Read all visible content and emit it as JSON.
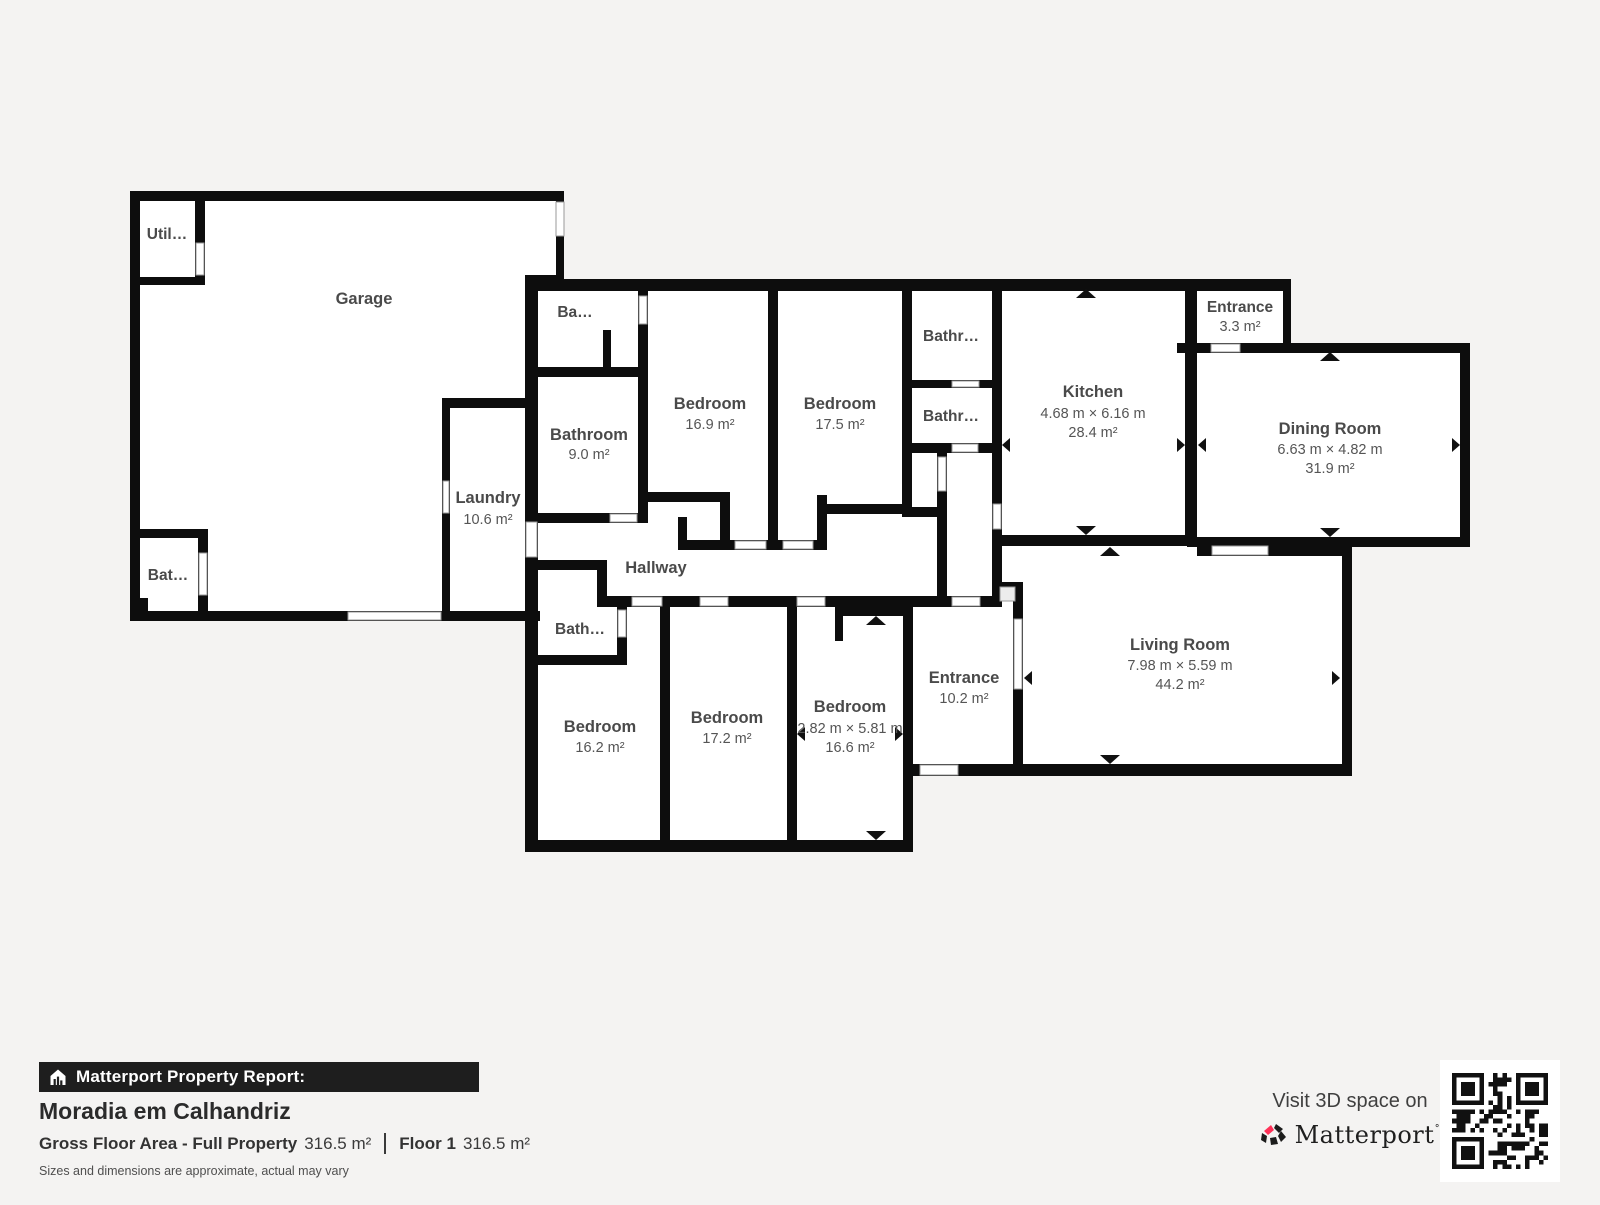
{
  "floorplan": {
    "rooms": {
      "util": {
        "label": "Util…"
      },
      "garage": {
        "label": "Garage"
      },
      "bat": {
        "label": "Bat…"
      },
      "laundry": {
        "label": "Laundry",
        "area": "10.6 m²"
      },
      "ba": {
        "label": "Ba…"
      },
      "bathroom": {
        "label": "Bathroom",
        "area": "9.0 m²"
      },
      "bedroom_169": {
        "label": "Bedroom",
        "area": "16.9 m²"
      },
      "bedroom_175": {
        "label": "Bedroom",
        "area": "17.5 m²"
      },
      "bathr_upper": {
        "label": "Bathr…"
      },
      "bathr_lower": {
        "label": "Bathr…"
      },
      "kitchen": {
        "label": "Kitchen",
        "dims": "4.68 m × 6.16 m",
        "area": "28.4 m²"
      },
      "entrance_33": {
        "label": "Entrance",
        "area": "3.3 m²"
      },
      "dining": {
        "label": "Dining Room",
        "dims": "6.63 m × 4.82 m",
        "area": "31.9 m²"
      },
      "hallway": {
        "label": "Hallway"
      },
      "bath_lower": {
        "label": "Bath…"
      },
      "bedroom_162": {
        "label": "Bedroom",
        "area": "16.2 m²"
      },
      "bedroom_172": {
        "label": "Bedroom",
        "area": "17.2 m²"
      },
      "bedroom_166": {
        "label": "Bedroom",
        "dims": "2.82 m × 5.81 m",
        "area": "16.6 m²"
      },
      "entrance_102": {
        "label": "Entrance",
        "area": "10.2 m²"
      },
      "living": {
        "label": "Living Room",
        "dims": "7.98 m × 5.59 m",
        "area": "44.2 m²"
      }
    },
    "colors": {
      "wall": "#0d0d0d",
      "room_fill": "#ffffff",
      "background": "#f4f3f2"
    }
  },
  "footer": {
    "report_label": "Matterport Property Report:",
    "property_name": "Moradia em Calhandriz",
    "gfa_label": "Gross Floor Area - Full Property",
    "gfa_value": "316.5 m²",
    "floor_label": "Floor 1",
    "floor_value": "316.5 m²",
    "disclaimer": "Sizes and dimensions are approximate, actual may vary",
    "visit_label": "Visit 3D space on",
    "brand": "Matterport"
  },
  "icons": {
    "house_icon": "house-with-bar-chart",
    "matterport_icon": "pinwheel-logo",
    "qr_code": "qr-code",
    "dimension_arrows": "triangle-arrows",
    "brand_pink": "#ff3158"
  }
}
